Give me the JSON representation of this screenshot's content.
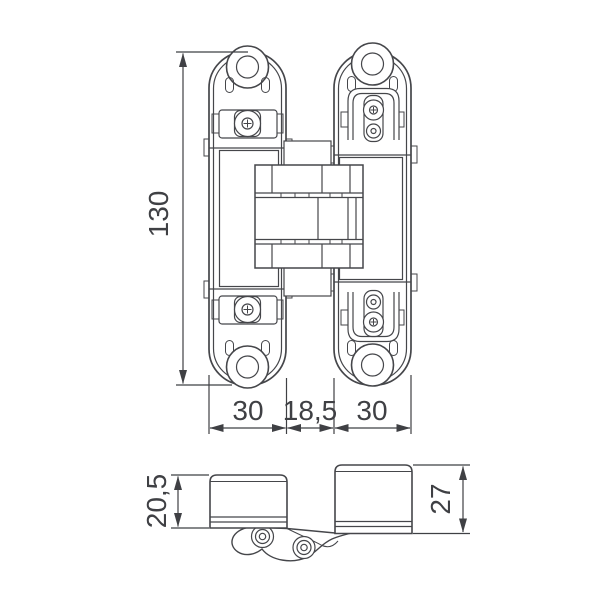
{
  "drawing": {
    "colors": {
      "line": "#45464a",
      "dimension_line": "#3f4044",
      "text": "#3f4044",
      "background": "#ffffff"
    },
    "dimensions": {
      "height": "130",
      "left_leaf_width": "30",
      "center_gap": "18,5",
      "right_leaf_width": "30",
      "left_leaf_depth": "20,5",
      "right_leaf_depth": "27"
    }
  }
}
